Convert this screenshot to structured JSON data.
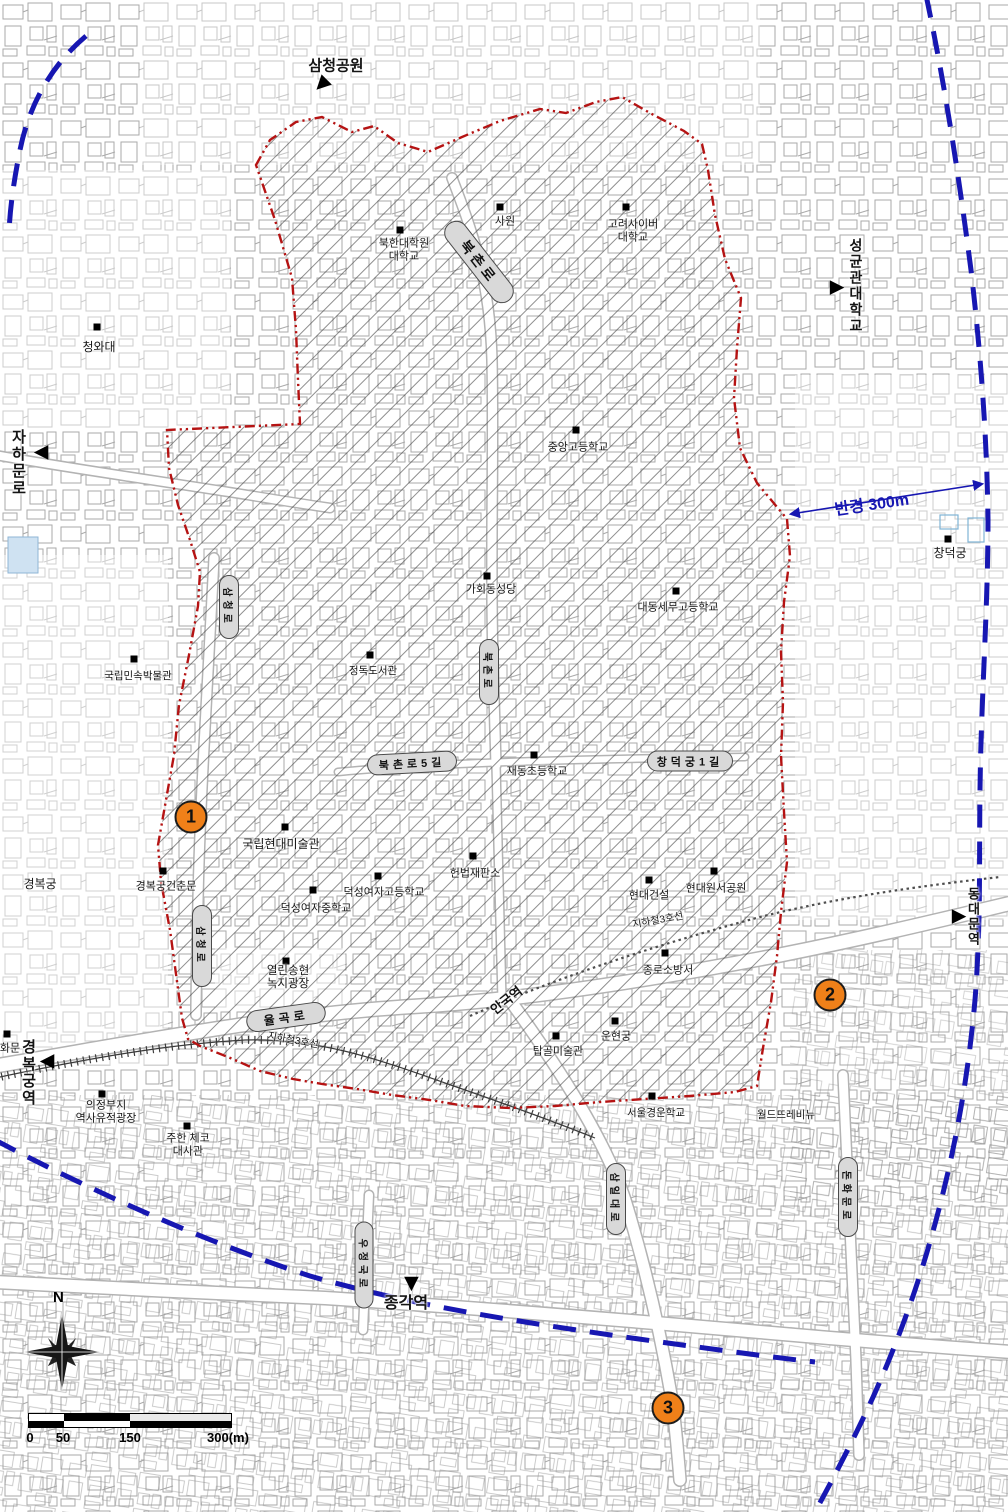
{
  "title": "Bukchon area site map with 300m radius",
  "colors": {
    "boundary_red": "#b51313",
    "radius_blue": "#1717b2",
    "marker_orange": "#ef8019"
  },
  "compass": {
    "letter": "N"
  },
  "scalebar": {
    "labels": [
      "0",
      "50",
      "150",
      "300(m)"
    ]
  },
  "arrow_glyph": "▶",
  "map": {
    "labels": [
      {
        "t": "삼청공원",
        "x": 336,
        "y": 66,
        "fs": 15,
        "b": true
      },
      {
        "t": "청와대",
        "x": 99,
        "y": 348,
        "fs": 12
      },
      {
        "t": "북한대학원\n대학교",
        "x": 404,
        "y": 250,
        "fs": 11
      },
      {
        "t": "사원",
        "x": 505,
        "y": 222,
        "fs": 11
      },
      {
        "t": "고려사이버\n대학교",
        "x": 633,
        "y": 231,
        "fs": 11
      },
      {
        "t": "중앙고등학교",
        "x": 578,
        "y": 448,
        "fs": 11
      },
      {
        "t": "가회동성당",
        "x": 491,
        "y": 590,
        "fs": 11
      },
      {
        "t": "대동세무고등학교",
        "x": 678,
        "y": 608,
        "fs": 11
      },
      {
        "t": "정독도서관",
        "x": 373,
        "y": 671,
        "fs": 10.5
      },
      {
        "t": "재동초등학교",
        "x": 537,
        "y": 772,
        "fs": 11
      },
      {
        "t": "국립현대미술관",
        "x": 281,
        "y": 845,
        "fs": 12
      },
      {
        "t": "경복궁건춘문",
        "x": 166,
        "y": 887,
        "fs": 11
      },
      {
        "t": "헌법재판소",
        "x": 475,
        "y": 874,
        "fs": 11
      },
      {
        "t": "덕성여자고등학교",
        "x": 384,
        "y": 893,
        "fs": 11
      },
      {
        "t": "덕성여자중학교",
        "x": 316,
        "y": 909,
        "fs": 11
      },
      {
        "t": "현대건설",
        "x": 649,
        "y": 896,
        "fs": 11
      },
      {
        "t": "현대원서공원",
        "x": 716,
        "y": 889,
        "fs": 11
      },
      {
        "t": "종로소방서",
        "x": 668,
        "y": 971,
        "fs": 11
      },
      {
        "t": "열린송현\n녹지광장",
        "x": 288,
        "y": 978,
        "fs": 11.5
      },
      {
        "t": "운현궁",
        "x": 616,
        "y": 1037,
        "fs": 11
      },
      {
        "t": "탑골미술관",
        "x": 558,
        "y": 1052,
        "fs": 11
      },
      {
        "t": "화문",
        "x": 10,
        "y": 1049,
        "fs": 11
      },
      {
        "t": "의정부지\n역사유적광장",
        "x": 106,
        "y": 1112,
        "fs": 11
      },
      {
        "t": "주한 체코\n대사관",
        "x": 188,
        "y": 1145,
        "fs": 11
      },
      {
        "t": "서울경운학교",
        "x": 656,
        "y": 1113,
        "fs": 10.5
      },
      {
        "t": "월드뜨레비뉴",
        "x": 786,
        "y": 1115,
        "fs": 10.5
      },
      {
        "t": "창덕궁",
        "x": 950,
        "y": 554,
        "fs": 12
      },
      {
        "t": "경복궁",
        "x": 40,
        "y": 885,
        "fs": 12
      },
      {
        "t": "국립민속박물관",
        "x": 138,
        "y": 676,
        "fs": 10.5
      },
      {
        "t": "종각역",
        "x": 406,
        "y": 1304,
        "fs": 16,
        "b": true
      },
      {
        "t": "안국역",
        "x": 507,
        "y": 1001,
        "fs": 13,
        "b": true,
        "rot": -38
      },
      {
        "t": "지하철3호선",
        "x": 293,
        "y": 1041,
        "fs": 10,
        "rot": 10
      },
      {
        "t": "지하철3호선",
        "x": 658,
        "y": 921,
        "fs": 10,
        "rot": -10
      },
      {
        "t": "반경 300m",
        "x": 872,
        "y": 506,
        "fs": 16,
        "b": true,
        "rot": -8,
        "c": "#1717b2"
      },
      {
        "t": "자하문로",
        "x": 18,
        "y": 463,
        "fs": 15,
        "b": true,
        "v": true
      },
      {
        "t": "성균관대학교",
        "x": 856,
        "y": 286,
        "fs": 14,
        "b": true,
        "v": true
      },
      {
        "t": "경복궁역",
        "x": 28,
        "y": 1073,
        "fs": 15,
        "b": true,
        "v": true
      },
      {
        "t": "동대문역",
        "x": 973,
        "y": 917,
        "fs": 13,
        "b": true,
        "v": true
      }
    ],
    "road_pills": [
      {
        "t": "북촌로",
        "x": 479,
        "y": 262,
        "long": 96,
        "short": 22,
        "rot": 52,
        "fs": 14
      },
      {
        "t": "삼청로",
        "x": 229,
        "y": 607,
        "long": 62,
        "short": 18,
        "rot": 90,
        "fs": 10
      },
      {
        "t": "북촌로",
        "x": 489,
        "y": 672,
        "long": 64,
        "short": 18,
        "rot": 90,
        "fs": 10
      },
      {
        "t": "북촌로5길",
        "x": 412,
        "y": 763,
        "long": 88,
        "short": 19,
        "rot": -3,
        "fs": 11
      },
      {
        "t": "창덕궁1길",
        "x": 690,
        "y": 761,
        "long": 84,
        "short": 19,
        "rot": 0,
        "fs": 11
      },
      {
        "t": "삼청로",
        "x": 202,
        "y": 946,
        "long": 80,
        "short": 18,
        "rot": 90,
        "fs": 10
      },
      {
        "t": "율곡로",
        "x": 286,
        "y": 1017,
        "long": 78,
        "short": 20,
        "rot": -8,
        "fs": 12
      },
      {
        "t": "돈화문로",
        "x": 848,
        "y": 1197,
        "long": 78,
        "short": 18,
        "rot": 90,
        "fs": 10
      },
      {
        "t": "삼일대로",
        "x": 616,
        "y": 1199,
        "long": 70,
        "short": 18,
        "rot": 90,
        "fs": 10
      },
      {
        "t": "우정국로",
        "x": 364,
        "y": 1265,
        "long": 85,
        "short": 17,
        "rot": 90,
        "fs": 10
      }
    ],
    "site_markers": [
      {
        "x": 97,
        "y": 327
      },
      {
        "x": 400,
        "y": 230
      },
      {
        "x": 500,
        "y": 207
      },
      {
        "x": 626,
        "y": 207
      },
      {
        "x": 576,
        "y": 430
      },
      {
        "x": 487,
        "y": 576
      },
      {
        "x": 676,
        "y": 591
      },
      {
        "x": 370,
        "y": 655
      },
      {
        "x": 534,
        "y": 755
      },
      {
        "x": 285,
        "y": 827
      },
      {
        "x": 163,
        "y": 871
      },
      {
        "x": 473,
        "y": 856
      },
      {
        "x": 378,
        "y": 876
      },
      {
        "x": 313,
        "y": 890
      },
      {
        "x": 649,
        "y": 880
      },
      {
        "x": 714,
        "y": 871
      },
      {
        "x": 665,
        "y": 953
      },
      {
        "x": 286,
        "y": 961
      },
      {
        "x": 615,
        "y": 1021
      },
      {
        "x": 556,
        "y": 1036
      },
      {
        "x": 7,
        "y": 1034
      },
      {
        "x": 102,
        "y": 1094
      },
      {
        "x": 187,
        "y": 1126
      },
      {
        "x": 652,
        "y": 1096
      },
      {
        "x": 948,
        "y": 539
      },
      {
        "x": 134,
        "y": 659
      }
    ],
    "numbered_points": [
      {
        "n": "1",
        "x": 191,
        "y": 817
      },
      {
        "n": "2",
        "x": 830,
        "y": 995
      },
      {
        "n": "3",
        "x": 668,
        "y": 1408
      }
    ],
    "direction_arrows": [
      {
        "x": 322,
        "y": 85,
        "rot": 135
      },
      {
        "x": 837,
        "y": 287,
        "rot": 0
      },
      {
        "x": 41,
        "y": 453,
        "rot": 180
      },
      {
        "x": 47,
        "y": 1062,
        "rot": 180
      },
      {
        "x": 412,
        "y": 1284,
        "rot": 90
      },
      {
        "x": 959,
        "y": 916,
        "rot": 0
      }
    ]
  }
}
